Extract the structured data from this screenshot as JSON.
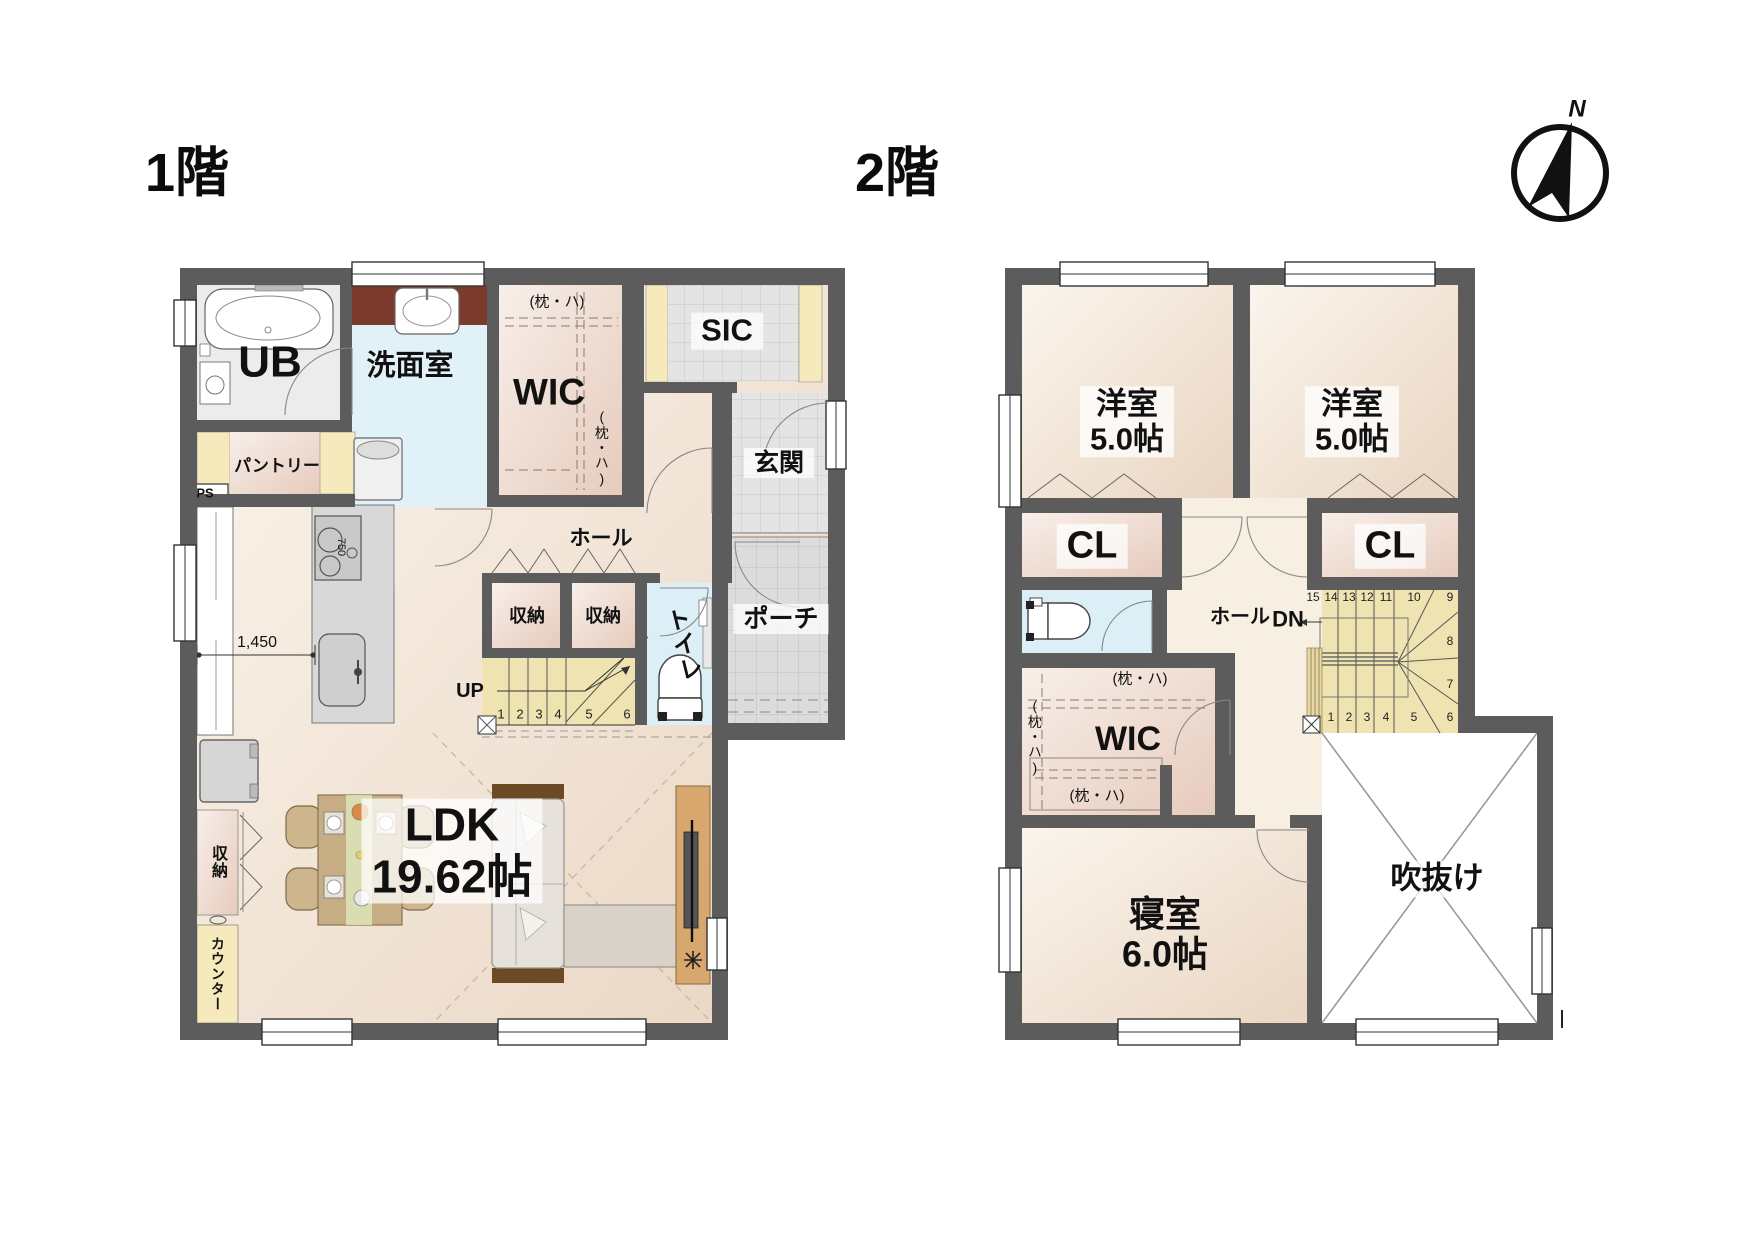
{
  "floor1": {
    "title": "1階",
    "labels": {
      "ub": "UB",
      "washroom": "洗面室",
      "wic": "WIC",
      "wic_note_top": "(枕・ハ)",
      "wic_note_side": "(枕・ハ)",
      "sic": "SIC",
      "entrance": "玄関",
      "porch": "ポーチ",
      "pantry": "パントリー",
      "ps": "PS",
      "hall": "ホール",
      "closet_a": "収納",
      "closet_b": "収納",
      "toilet": "トイレ",
      "up": "UP",
      "ldk_name": "LDK",
      "ldk_size": "19.62帖",
      "closet_left": "収納",
      "counter": "カウンター",
      "dim_width": "1,450",
      "stove_dim": "750"
    },
    "stair_numbers": [
      "1",
      "2",
      "3",
      "4",
      "5",
      "6"
    ]
  },
  "floor2": {
    "title": "2階",
    "labels": {
      "room1_name": "洋室",
      "room1_size": "5.0帖",
      "room2_name": "洋室",
      "room2_size": "5.0帖",
      "cl_left": "CL",
      "cl_right": "CL",
      "hall": "ホール",
      "dn": "DN",
      "wic": "WIC",
      "wic_note_top": "(枕・ハ)",
      "wic_note_side": "(枕・ハ)",
      "wic_note_bottom": "(枕・ハ)",
      "bedroom_name": "寝室",
      "bedroom_size": "6.0帖",
      "void": "吹抜け"
    },
    "stair_top": [
      "15",
      "14",
      "13",
      "12",
      "11",
      "10",
      "9"
    ],
    "stair_side": [
      "8",
      "7"
    ],
    "stair_bottom": [
      "1",
      "2",
      "3",
      "4",
      "5",
      "6"
    ]
  },
  "compass": {
    "north": "N"
  },
  "colors": {
    "wall": "#5c5c5c",
    "floor_cream": "#f2e4d4",
    "closet_pink": "#eed9cd",
    "stair_yellow": "#efe3b2",
    "shelf_yellow": "#f6e9bc",
    "water_blue": "#dceff6",
    "tile_gray": "#e4e4e4",
    "vanity_brown": "#7a3b2c"
  }
}
